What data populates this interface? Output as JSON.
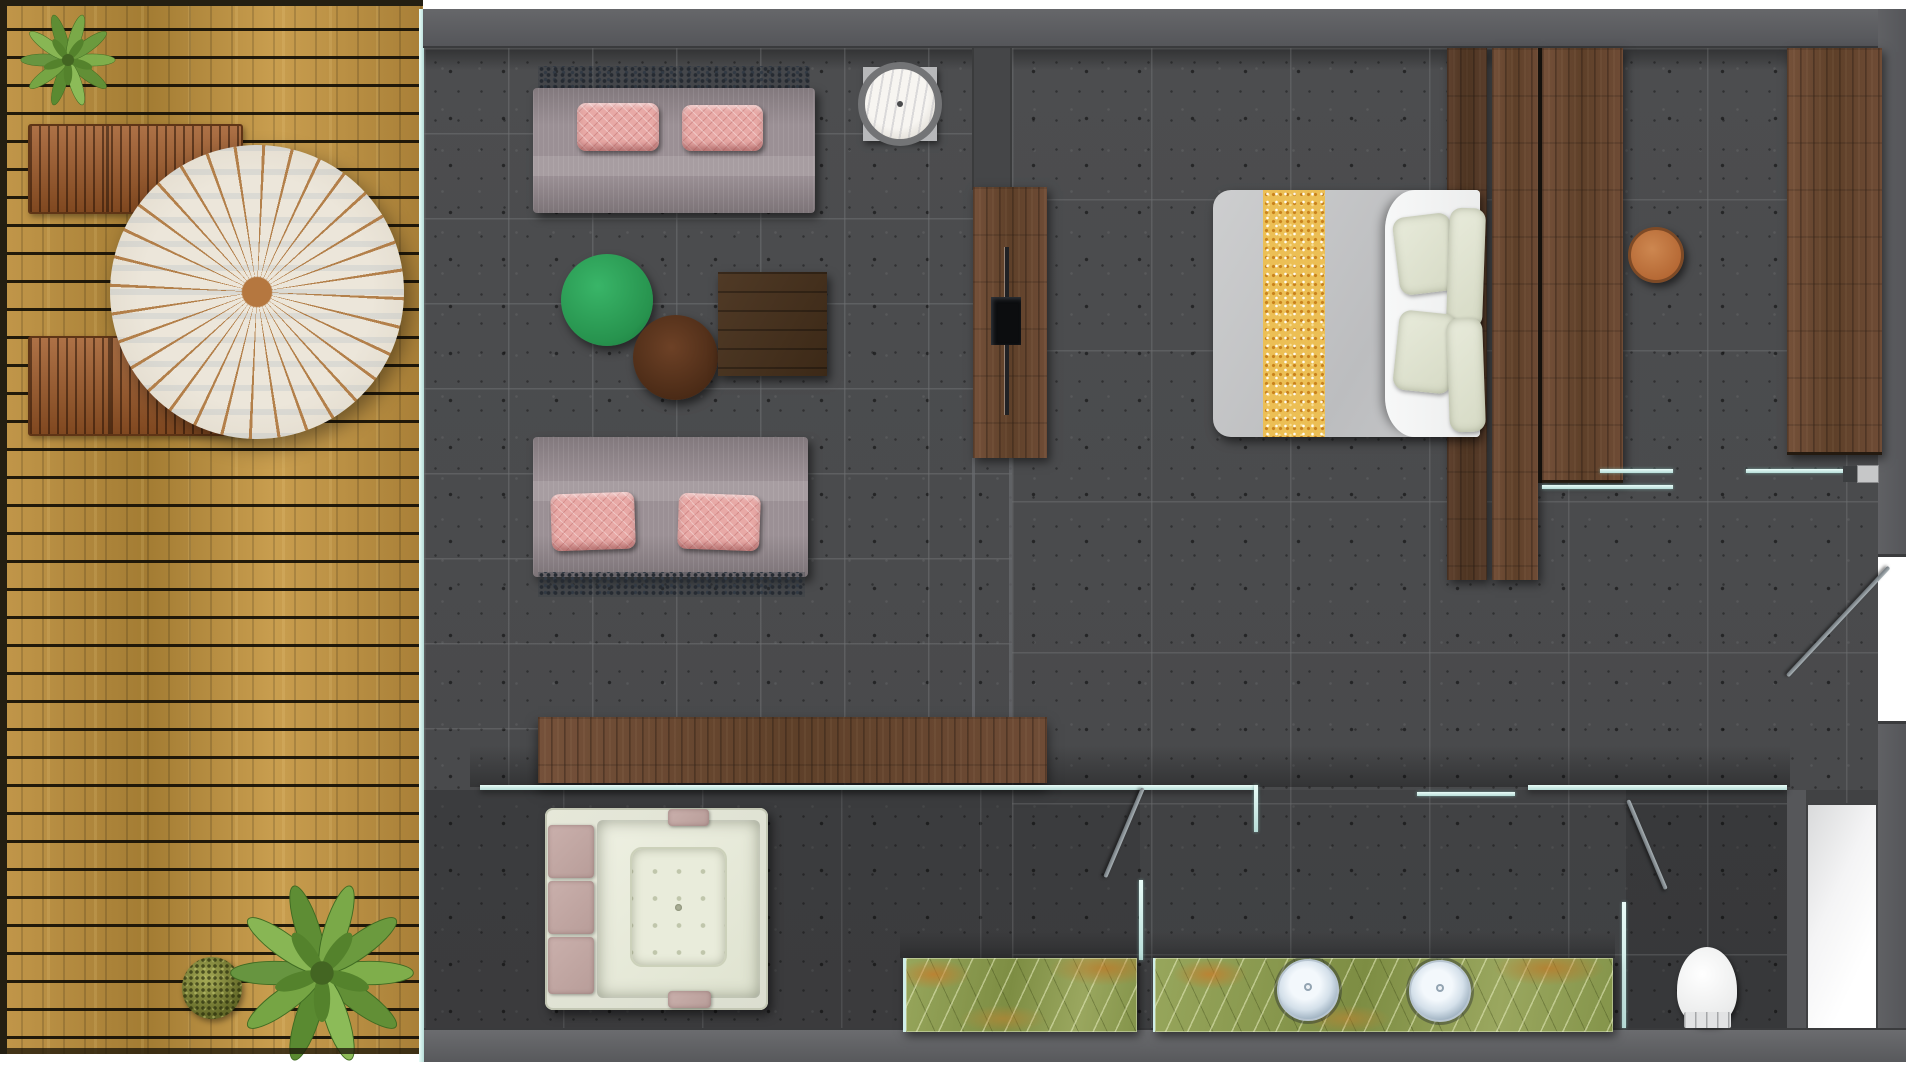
{
  "scene": {
    "type": "residential-suite-floor-plan-top-view",
    "rooms": [
      {
        "id": "terrace",
        "label": "outdoor wooden deck"
      },
      {
        "id": "living-area",
        "label": "lounge with two sofas and TV wall"
      },
      {
        "id": "bedroom",
        "label": "bedroom with double bed and wardrobes"
      },
      {
        "id": "bathroom",
        "label": "bathroom with jacuzzi and double vanity"
      },
      {
        "id": "wc",
        "label": "separate toilet room"
      },
      {
        "id": "entry",
        "label": "entry door on right wall"
      }
    ],
    "furniture": [
      "parasol-umbrella",
      "sun-lounger x2",
      "potted-plant x3",
      "moss-shrub",
      "sofa x2",
      "pink-cushion x4",
      "marble-side-table",
      "green-ottoman",
      "brown-ottoman",
      "coffee-table",
      "tv-wall-unit",
      "tv",
      "wood-sideboard-console",
      "double-bed",
      "gold-bed-runner",
      "bed-pillow x4",
      "wardrobe-column x4",
      "dressing-stool",
      "jacuzzi-tub",
      "tub-cushion x5",
      "onyx-vanity-counter x2",
      "round-sink x2",
      "toilet",
      "shower-tray",
      "glass-partition x7",
      "swing-door x3"
    ],
    "counts": {
      "sofas": 2,
      "sinks": 2,
      "doors": 3,
      "wardrobe_columns": 4,
      "loungers": 2
    }
  },
  "palette": {
    "background": "#ffffff",
    "floor_tile": "#4a4b4d",
    "wall": "#5e5f61",
    "deck_wood": "#b38739",
    "furniture_wood": "#6b4a35",
    "glass_partition": "#cdeeea",
    "sofa_fabric": "#9b9095",
    "pillow_pink": "#e8a9a6",
    "ottoman_green": "#27934e",
    "ottoman_brown": "#4a2a16",
    "bed_mattress": "#c6c7c9",
    "bed_runner_gold": "#ecbf55",
    "bed_pillow_ivory": "#e0e3d2",
    "counter_onyx_green": "#8b9b50",
    "onyx_vein_orange": "#c97a28",
    "umbrella_canvas": "#ece6da",
    "umbrella_ribs": "#b07a42",
    "plant_green": "#7cab49",
    "stool_leather": "#bf7540",
    "tub_shell": "#e2e4d5",
    "tub_cushion_mauve": "#c3a8a4",
    "fixture_white": "#f4f5f6",
    "tv_black": "#0c0d0f"
  }
}
